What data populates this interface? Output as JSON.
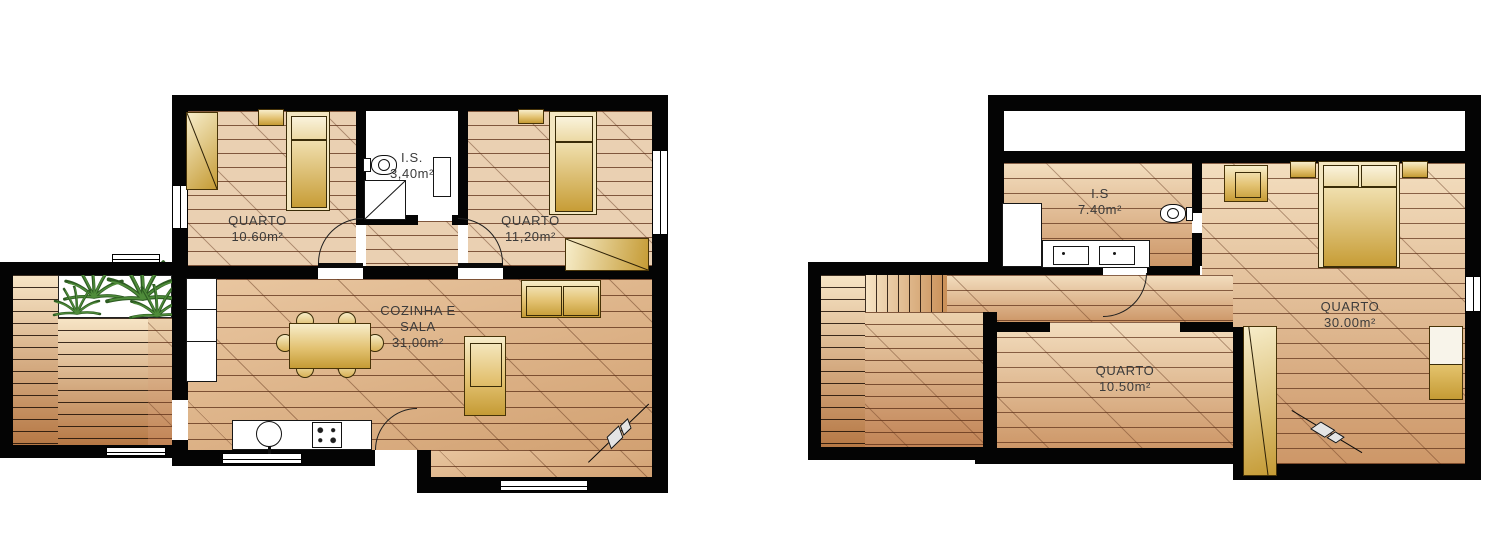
{
  "document": {
    "type": "architectural floor plans",
    "language": "Portuguese",
    "units": "m²"
  },
  "ground_floor": {
    "rooms": {
      "bedroom1": {
        "label": "QUARTO",
        "area": "10.60m²"
      },
      "bathroom": {
        "label": "I.S.",
        "area": "3,40m²"
      },
      "bedroom2": {
        "label": "QUARTO",
        "area": "11,20m²"
      },
      "living": {
        "label1": "COZINHA E",
        "label2": "SALA",
        "area": "31,00m²"
      }
    }
  },
  "upper_floor": {
    "rooms": {
      "bathroom": {
        "label": "I.S",
        "area": "7.40m²"
      },
      "bedroom_large": {
        "label": "QUARTO",
        "area": "30.00m²"
      },
      "bedroom_small": {
        "label": "QUARTO",
        "area": "10.50m²"
      }
    }
  },
  "colors": {
    "wall": "#040404",
    "paper": "#ffffff",
    "floor_bedroom": "#ead0b2",
    "floor_living": "#d2a172",
    "floor_upper_top": "#f3debf",
    "floor_upper_bottom": "#cd9768",
    "furniture_light": "#f7edca",
    "furniture_dark": "#c59b35",
    "plank_line": "#5c2e16",
    "plant_green": "#2d5c22"
  }
}
